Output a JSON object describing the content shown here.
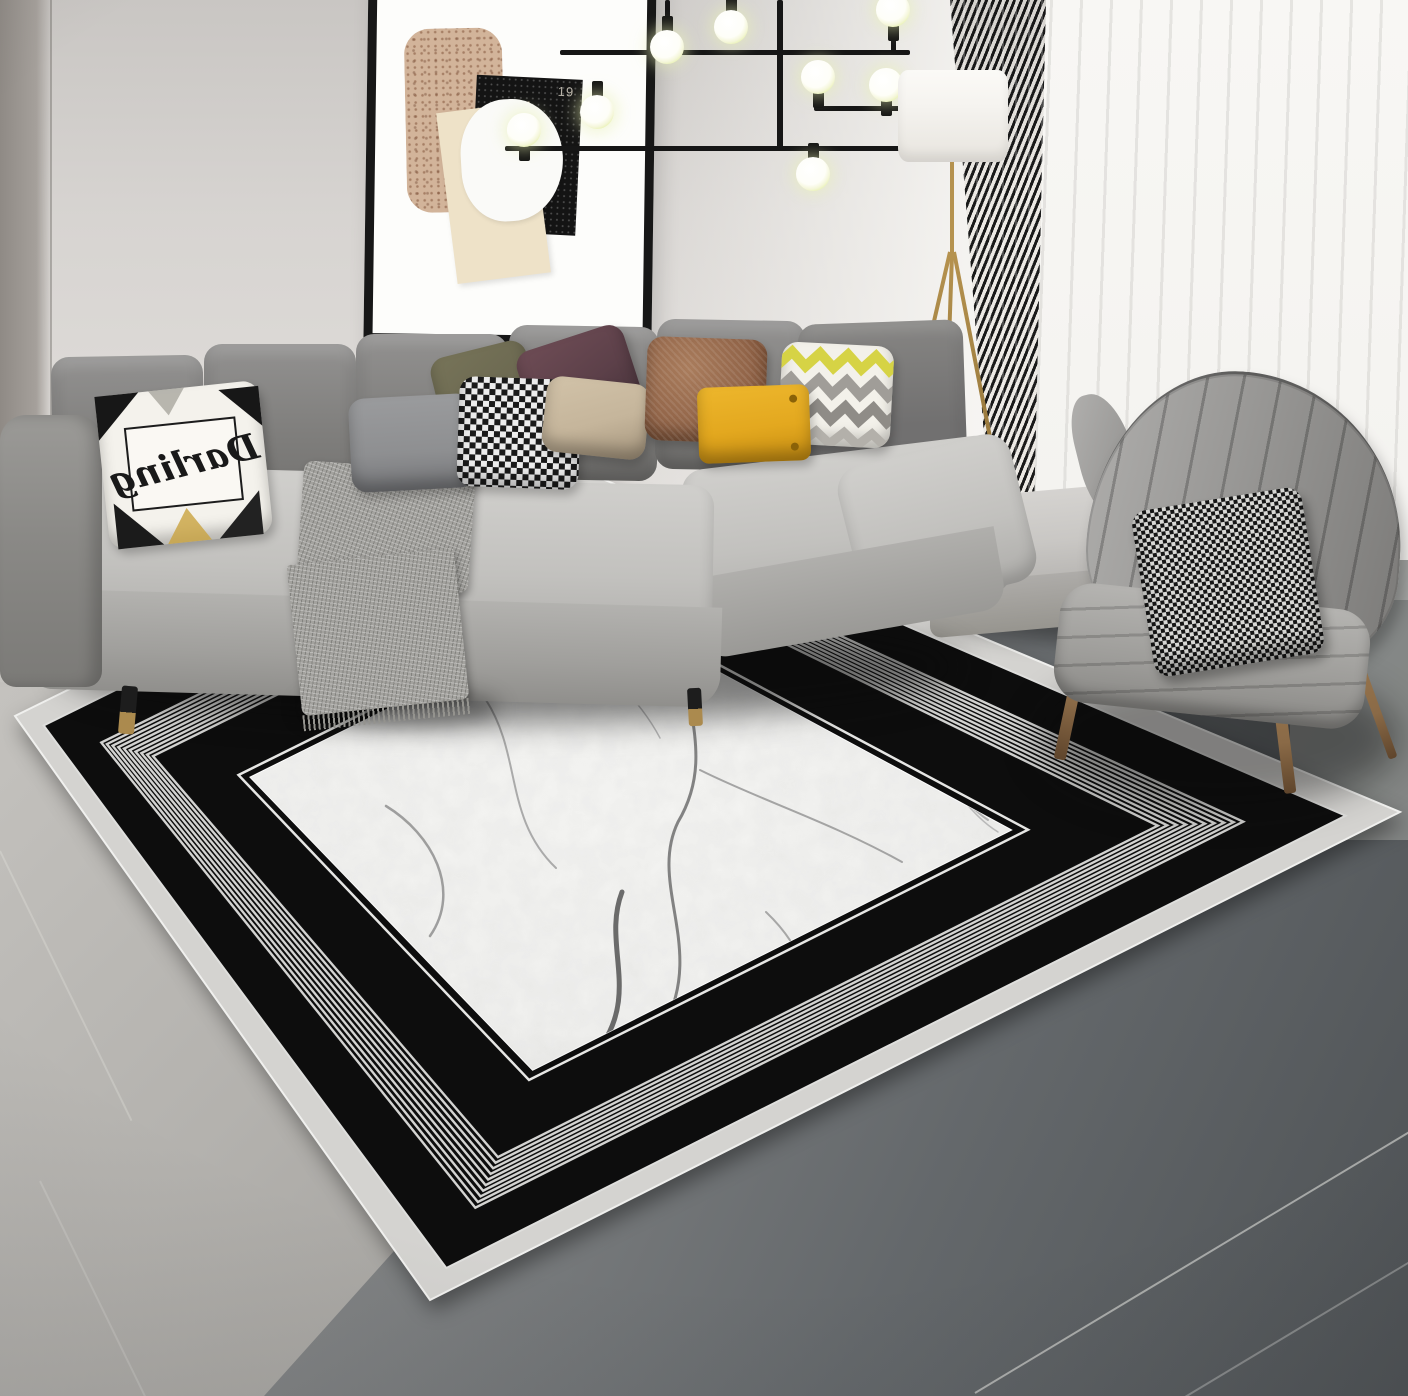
{
  "scene": {
    "description": "Modern living room product photo: black and white concentric-border rug with marble center, gray L-shaped sectional sofa with throw pillows, wingback armchair, sputnik chandelier, framed abstract art, drum floor lamp and curtains",
    "dimensions": "1408x1396"
  },
  "palette": {
    "wall": "#d8d5d2",
    "sheer": "#f7f6f3",
    "rug_outer": "#d4d3d0",
    "rug_black": "#0d0d0d",
    "rug_stripe": "#dededc",
    "marble": "#f1f1ef",
    "bench": "#c9c7c4",
    "chair": "#989795",
    "wood": "#8a6a47",
    "gold": "#b5924e",
    "shade": "#f5f3ef",
    "bulb": "#fefef8",
    "glow": "#e9f2b4",
    "curt_dark": "#1a1a1a",
    "curt_light": "#ece9e4",
    "art_tan": "#d2b49a",
    "art_black": "#141414",
    "art_cream": "#eee2c8",
    "py": "#e3a81f",
    "prust": "#926549",
    "pplum": "#5c4049",
    "polive": "#6c6951",
    "ptan": "#c5b59b",
    "pgray": "#8e8f91",
    "chk_dark": "#1a1a1a",
    "chk_light": "#ededed",
    "chev_y": "#d6d345",
    "chev_g": "#a09d98"
  },
  "wall_art": {
    "number_label": "19"
  },
  "pillow_text": {
    "script_word": "Darling"
  },
  "rug": {
    "corners": {
      "back": [
        545,
        455
      ],
      "right": [
        1400,
        812
      ],
      "front": [
        430,
        1300
      ],
      "left": [
        15,
        716
      ]
    },
    "bands": {
      "outer_end": 0.03,
      "black1_end": 0.085,
      "stripes_end": 0.14,
      "black2_end": 0.215,
      "marble_start": 0.225
    },
    "stripe_count": 10,
    "veins": [
      {
        "d": "M692 612 C668 690 722 748 678 822 C648 884 706 948 664 1026 C646 1070 606 1086 584 1112",
        "w": 3,
        "c": "#6f6f6f"
      },
      {
        "d": "M700 770 C760 800 830 822 902 862",
        "w": 2,
        "c": "#979797"
      },
      {
        "d": "M486 700 C522 756 504 818 556 868",
        "w": 2,
        "c": "#9e9e9e"
      },
      {
        "d": "M386 806 C432 834 462 890 430 936",
        "w": 2.5,
        "c": "#8f8f8f"
      },
      {
        "d": "M896 682 C942 722 932 782 988 820",
        "w": 2,
        "c": "#a6a6a6"
      },
      {
        "d": "M622 892 C602 944 640 992 600 1048",
        "w": 5,
        "c": "#545454"
      },
      {
        "d": "M560 640 C600 660 640 700 660 738",
        "w": 1.5,
        "c": "#ababab"
      },
      {
        "d": "M766 912 C806 950 822 1000 800 1038",
        "w": 2,
        "c": "#9a9a9a"
      },
      {
        "d": "M930 766 C960 792 972 816 998 832",
        "w": 1.5,
        "c": "#b0b0b0"
      }
    ]
  },
  "chandelier": {
    "rods": [
      [
        505,
        146,
        412,
        5
      ],
      [
        560,
        50,
        350,
        5
      ],
      [
        814,
        106,
        326,
        5
      ],
      [
        777,
        0,
        6,
        150
      ],
      [
        522,
        138,
        5,
        10
      ],
      [
        595,
        88,
        5,
        26
      ],
      [
        665,
        0,
        5,
        32
      ],
      [
        729,
        0,
        5,
        14
      ],
      [
        816,
        92,
        5,
        16
      ],
      [
        884,
        100,
        5,
        8
      ],
      [
        811,
        150,
        5,
        16
      ],
      [
        891,
        25,
        5,
        27
      ]
    ],
    "bulbs": [
      {
        "x": 524,
        "y": 130,
        "s": "b"
      },
      {
        "x": 597,
        "y": 112,
        "s": "t"
      },
      {
        "x": 667,
        "y": 47,
        "s": "t"
      },
      {
        "x": 731,
        "y": 27,
        "s": "t"
      },
      {
        "x": 818,
        "y": 77,
        "s": "b"
      },
      {
        "x": 886,
        "y": 85,
        "s": "b"
      },
      {
        "x": 813,
        "y": 174,
        "s": "t"
      },
      {
        "x": 893,
        "y": 10,
        "s": "b"
      }
    ]
  }
}
